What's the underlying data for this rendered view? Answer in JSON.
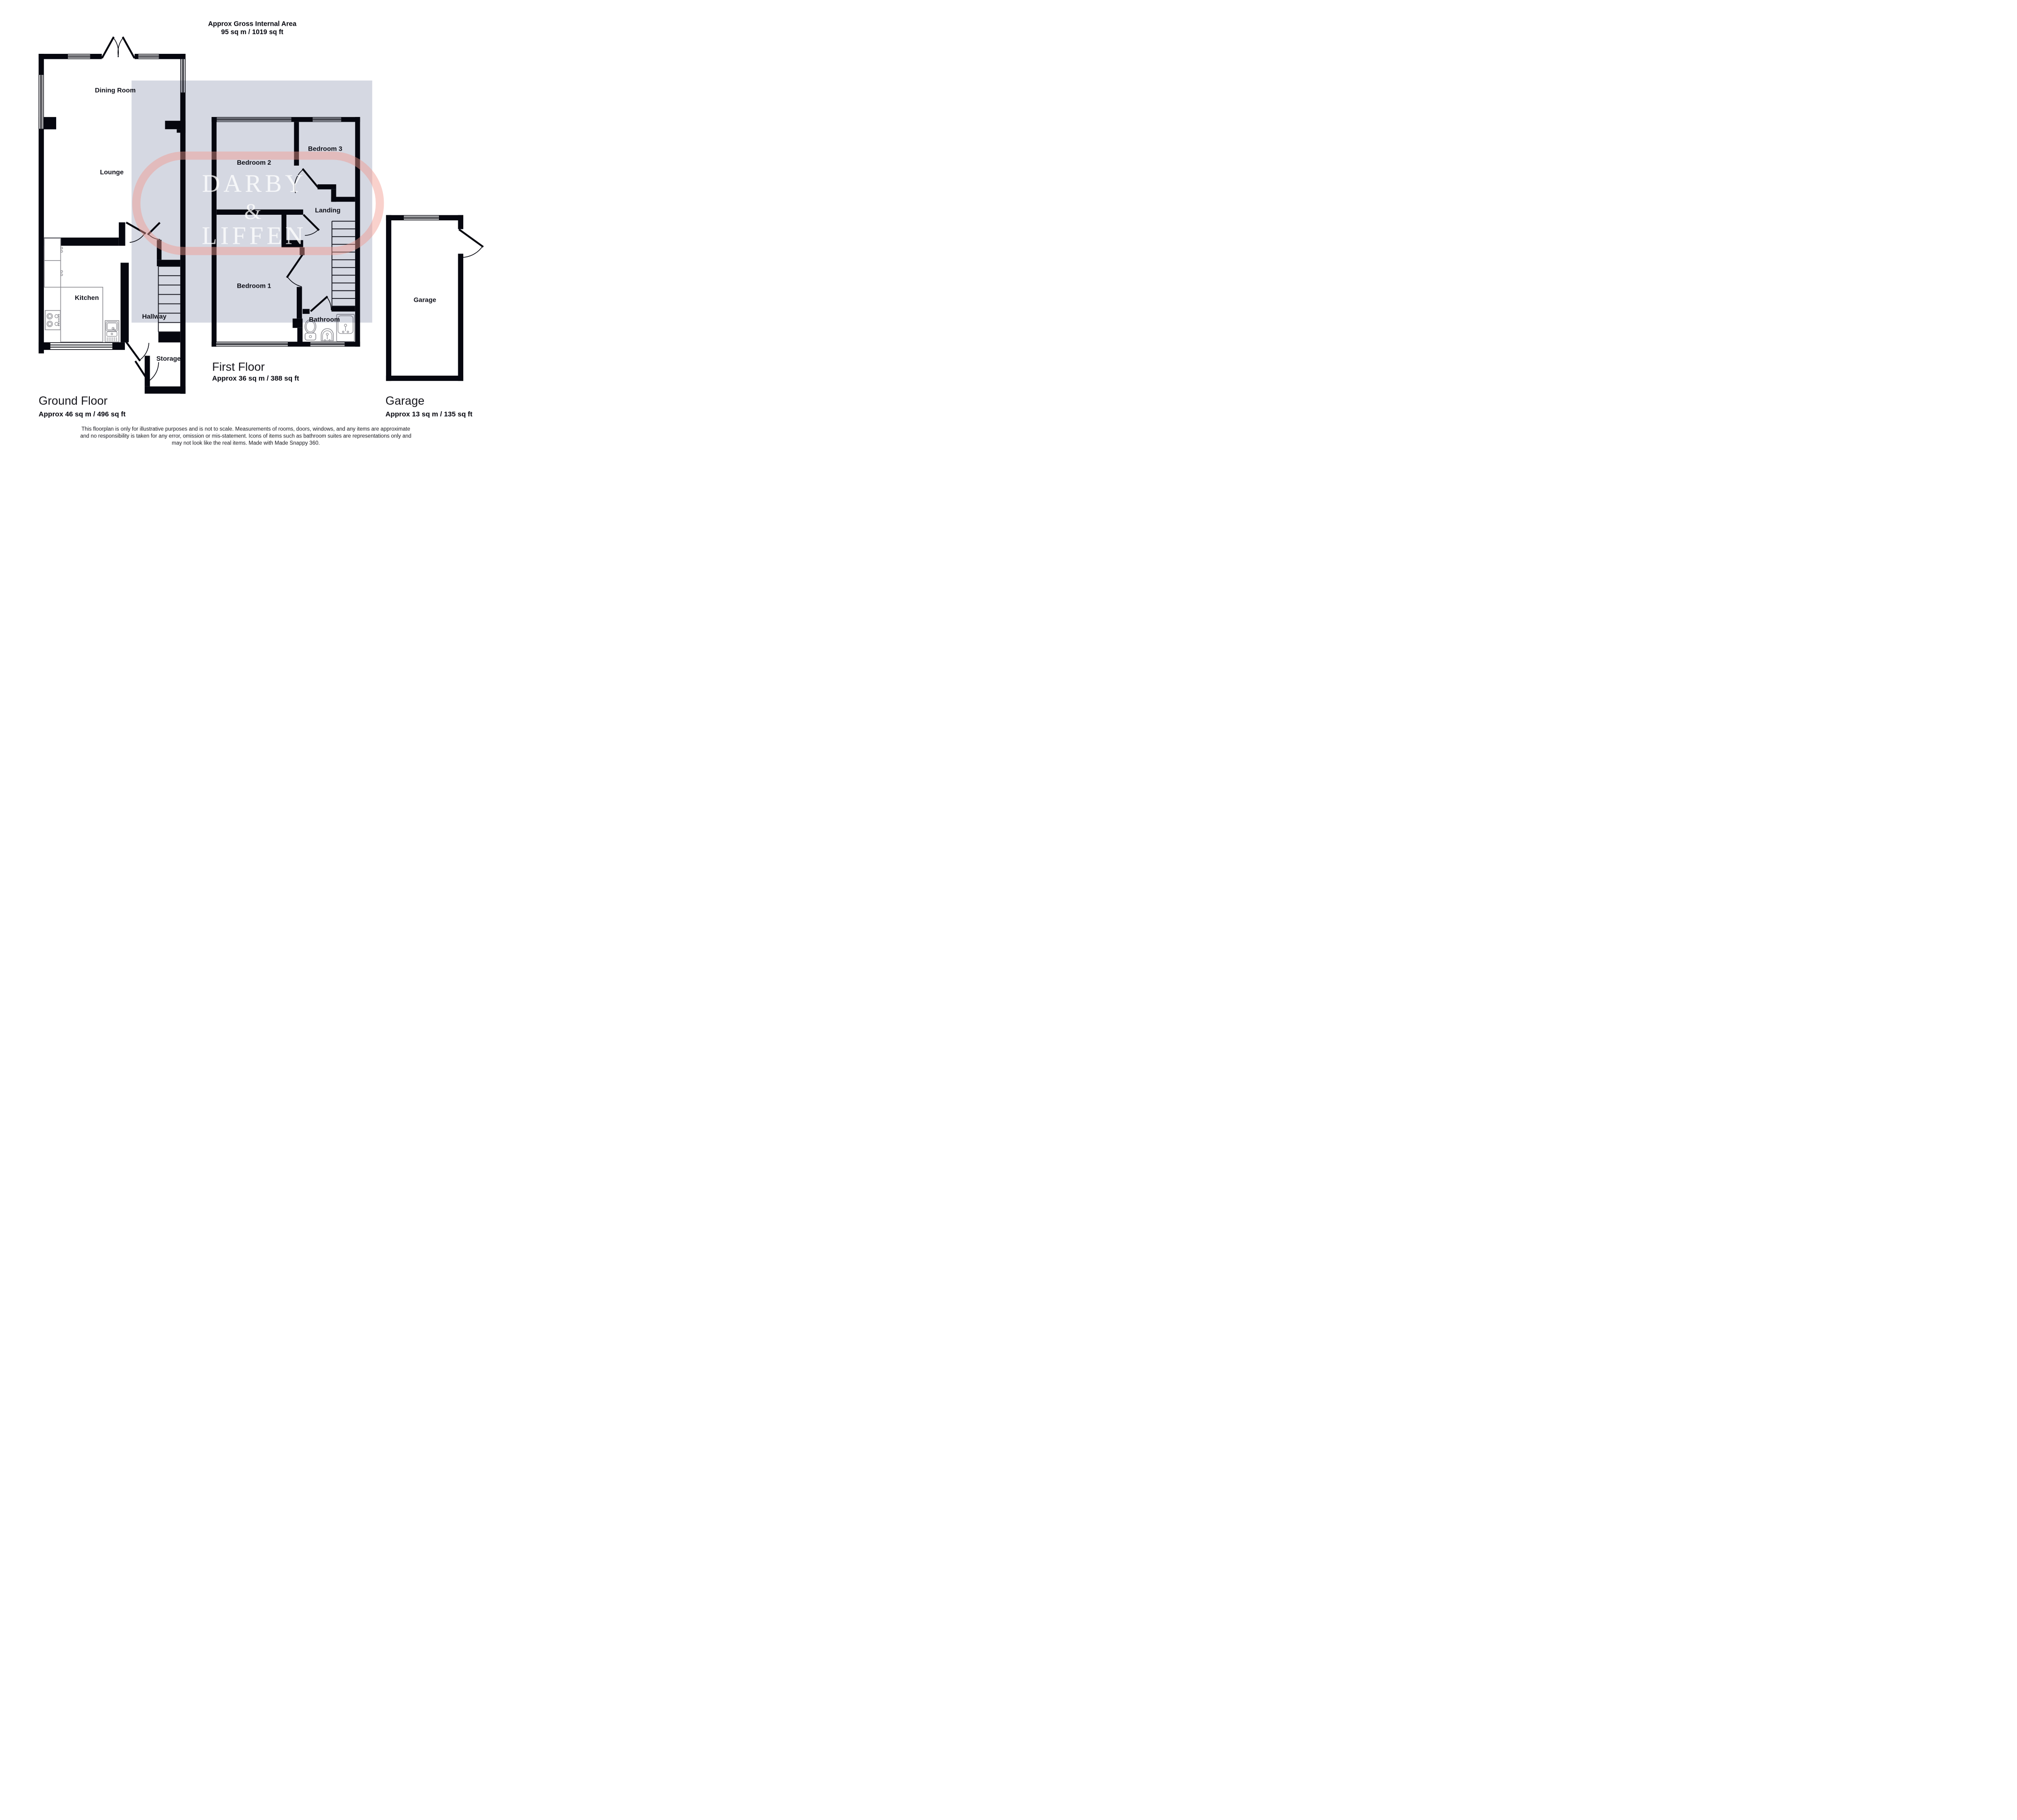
{
  "header": {
    "line1": "Approx Gross Internal Area",
    "line2": "95 sq m / 1019 sq ft"
  },
  "watermark": {
    "word1": "DARBY",
    "word2": "&",
    "word3": "LIFFEN",
    "overlay_color": "#d5d8e2",
    "ring_color": "#f2988e"
  },
  "ground_floor": {
    "title": "Ground Floor",
    "area": "Approx 46 sq m / 496 sq ft",
    "rooms": {
      "dining": "Dining Room",
      "lounge": "Lounge",
      "kitchen": "Kitchen",
      "hallway": "Hallway",
      "storage": "Storage"
    }
  },
  "first_floor": {
    "title": "First Floor",
    "area": "Approx 36 sq m / 388 sq ft",
    "rooms": {
      "bedroom2": "Bedroom 2",
      "bedroom3": "Bedroom 3",
      "landing": "Landing",
      "bedroom1": "Bedroom 1",
      "bathroom": "Bathroom"
    }
  },
  "garage": {
    "title": "Garage",
    "area": "Approx 13 sq m / 135 sq ft",
    "rooms": {
      "garage": "Garage"
    }
  },
  "disclaimer": {
    "line1": "This floorplan is only for illustrative purposes and is not to scale. Measurements of rooms, doors, windows, and any items are approximate",
    "line2": "and no responsibility is taken for any error, omission or mis-statement. Icons of items such as bathroom suites are representations only and",
    "line3": "may not look like the real items. Made with Made Snappy 360."
  }
}
